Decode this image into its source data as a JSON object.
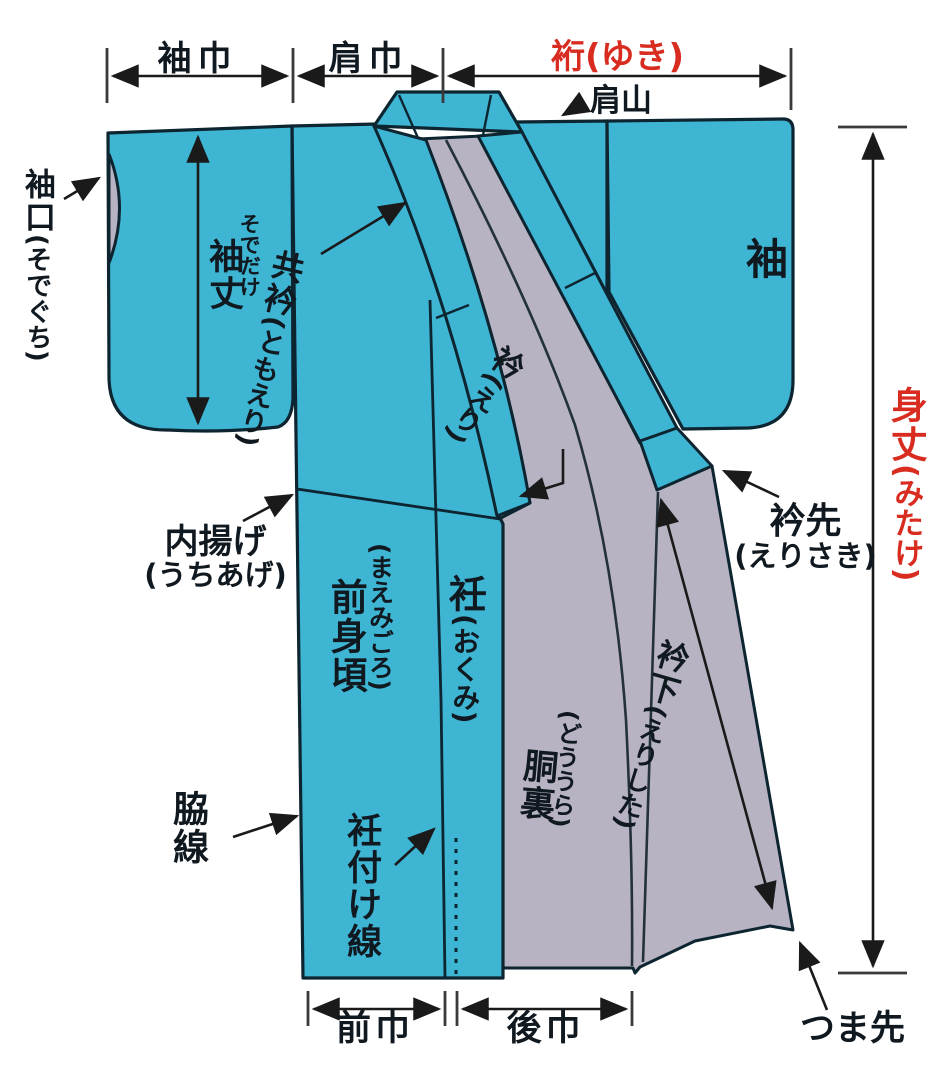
{
  "figure": {
    "kind": "kimono-parts-diagram",
    "colors": {
      "fabric_teal": "#3eb5d3",
      "lining_gray": "#b7b3c2",
      "outline_dark": "#0d2530",
      "accent_red": "#d92c21",
      "text": "#101820"
    },
    "top_measures": {
      "sode_haba": "袖巾",
      "kata_haba": "肩巾",
      "yuki": "裄(ゆき)"
    },
    "right_measure": {
      "mitake_main": "身丈",
      "mitake_reading": "(みたけ)"
    },
    "bottom_measures": {
      "mae_haba": "前巾",
      "ushiro_haba": "後巾"
    },
    "labels": {
      "katayama": "肩山",
      "sodeguchi_main": "袖口",
      "sodeguchi_reading": "(そでぐち)",
      "sodetake_reading": "そでだけ",
      "sodetake_main": "袖丈",
      "tomoeri_main": "共衿",
      "tomoeri_reading": "(ともえり)",
      "sode": "袖",
      "eri_main": "衿",
      "eri_reading": "(えり)",
      "erisaki_main": "衿先",
      "erisaki_reading": "(えりさき)",
      "uchiage_main": "内揚げ",
      "uchiage_reading": "(うちあげ)",
      "maemigoro_reading": "(まえみごろ)",
      "maemigoro_main": "前身頃",
      "okumi_main": "衽",
      "okumi_reading": "(おくみ)",
      "doura_reading": "(どううら)",
      "doura_main": "胴裏",
      "wakisen": "脇線",
      "okumitsuke": "衽付け線",
      "erishita_main": "衿下",
      "erishita_reading": "(えりした)",
      "tsumasaki": "つま先"
    }
  }
}
